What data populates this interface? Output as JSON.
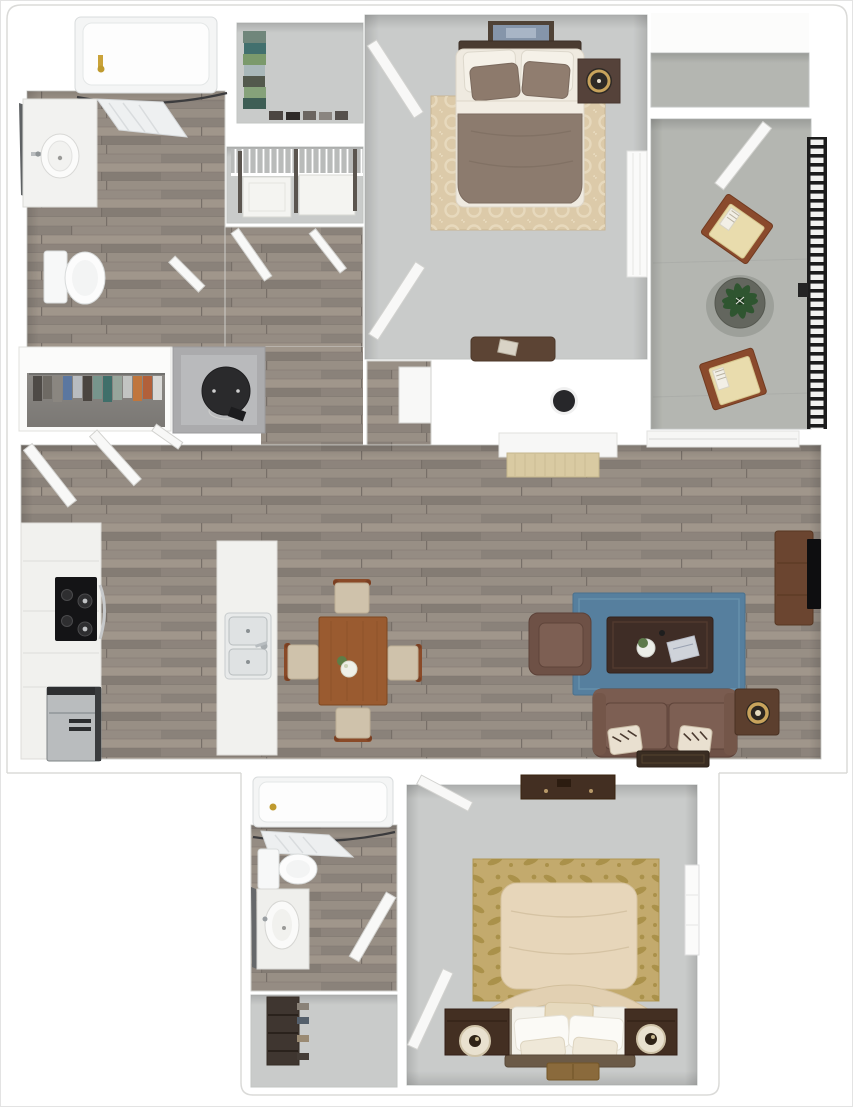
{
  "image": {
    "type": "3d-floorplan-render",
    "width": 853,
    "height": 1107,
    "background": "#ffffff",
    "visible_text": ""
  },
  "palette": {
    "wall": "#ffffff",
    "outline": "#d6d6d4",
    "wood_floor": "#918980",
    "carpet": "#c9cbca",
    "concrete": "#b4b6b1",
    "rug_living": "#567f9e",
    "rug_bedroom1": "#dccaa9",
    "rug_bedroom2": "#c3aa6d",
    "bed1_comforter": "#8c7b6e",
    "bed1_sheets": "#f1ece1",
    "bed2_comforter": "#e7d6ba",
    "sofa": "#6e5146",
    "sofa_cushion": "#7d5f53",
    "coffee_table": "#3f2d26",
    "dining_table": "#9a5b30",
    "dining_chair_cushion": "#cfc2ab",
    "tv_console": "#6b4530",
    "tv": "#0e0e10",
    "stove": "#141416",
    "fridge": "#b9bcbe",
    "water_heater": "#2a2a2c",
    "railing": "#1d1d1d",
    "balcony_chair_frame": "#8a4a2c",
    "balcony_chair_cushion": "#e9dcad",
    "plant_leaves": "#2f5530",
    "nightstand_dark": "#432f22",
    "lamp_gold": "#c8a35c",
    "entry_mat": "#3a2d22",
    "bed2_mat": "#8a6a3c"
  },
  "rooms": [
    {
      "id": "bathroom-1",
      "label": "Bathroom 1",
      "floor": "wood",
      "items": [
        "bathtub",
        "shower-curtain-rod",
        "shower-curtain",
        "vanity-with-sink",
        "mirror",
        "toilet"
      ]
    },
    {
      "id": "closet-top",
      "label": "Linen Closet",
      "floor": "carpet",
      "items": [
        "folded-clothes-stack",
        "shoe-row"
      ]
    },
    {
      "id": "closet-wire",
      "label": "Closet",
      "floor": "carpet",
      "items": [
        "wire-shelf",
        "storage-bin",
        "storage-bin"
      ]
    },
    {
      "id": "hallway",
      "label": "Hallway",
      "floor": "wood",
      "items": [
        "open-doors"
      ]
    },
    {
      "id": "bedroom-1",
      "label": "Bedroom 1",
      "floor": "carpet",
      "items": [
        "wall-art",
        "double-bed",
        "area-rug",
        "nightstand",
        "table-lamp",
        "foot-bench",
        "window"
      ]
    },
    {
      "id": "balcony-storage",
      "label": "Balcony Storage",
      "floor": "concrete",
      "items": [
        "door"
      ]
    },
    {
      "id": "balcony",
      "label": "Balcony",
      "floor": "concrete",
      "items": [
        "patio-chair",
        "patio-chair",
        "potted-plant",
        "metal-railing"
      ]
    },
    {
      "id": "hall-closet",
      "label": "Hall Closet",
      "floor": "dark",
      "items": [
        "hanging-clothes"
      ]
    },
    {
      "id": "utility-closet",
      "label": "Utility Closet",
      "floor": "concrete",
      "items": [
        "water-heater"
      ]
    },
    {
      "id": "kitchen",
      "label": "Kitchen",
      "floor": "wood",
      "items": [
        "counter-run",
        "stove",
        "refrigerator",
        "island",
        "double-sink"
      ]
    },
    {
      "id": "dining-area",
      "label": "Dining Area",
      "floor": "wood",
      "items": [
        "dining-table",
        "dining-chair",
        "dining-chair",
        "dining-chair",
        "dining-chair",
        "centerpiece-flowers"
      ]
    },
    {
      "id": "living-room",
      "label": "Living Room",
      "floor": "wood",
      "items": [
        "console-desk",
        "wall-dot-fixture",
        "sliding-door-sill",
        "blue-area-rug",
        "armchair",
        "coffee-table",
        "sofa",
        "throw-pillows",
        "side-table",
        "gold-lamp",
        "tv-console",
        "tv",
        "entry-mat"
      ]
    },
    {
      "id": "bathroom-2",
      "label": "Bathroom 2",
      "floor": "wood",
      "items": [
        "bathtub",
        "shower-curtain-rod",
        "shower-curtain",
        "toilet",
        "vanity-with-sink",
        "mirror",
        "door"
      ]
    },
    {
      "id": "closet-bottom",
      "label": "Bedroom 2 Closet",
      "floor": "carpet",
      "items": [
        "shoe-rack"
      ]
    },
    {
      "id": "bedroom-2",
      "label": "Bedroom 2",
      "floor": "carpet",
      "items": [
        "dresser",
        "damask-rug",
        "upholstered-bed",
        "pillows",
        "nightstand",
        "nightstand",
        "cream-lamp",
        "cream-lamp",
        "foot-mat",
        "window",
        "doors"
      ]
    }
  ]
}
